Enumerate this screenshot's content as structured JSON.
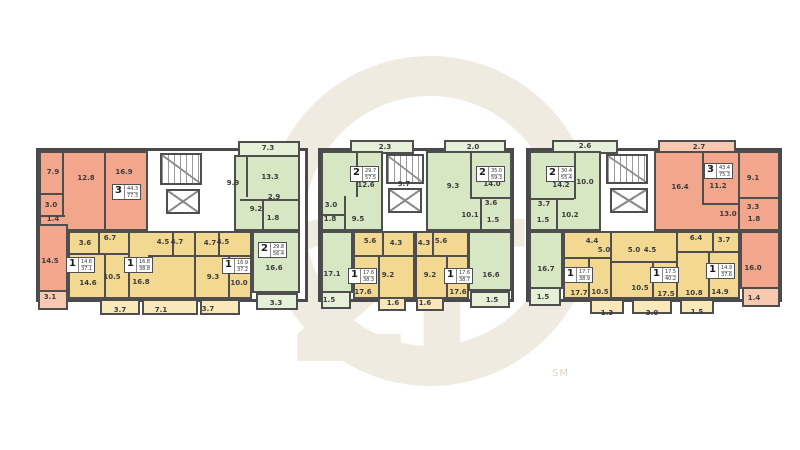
{
  "watermark": {
    "symbol": "2Г",
    "mark": "SM"
  },
  "b1": {
    "orange": {
      "badge": [
        "3",
        "44.3",
        "77.3"
      ],
      "rooms": [
        "7.9",
        "12.8",
        "16.9",
        "3.0",
        "1.4",
        "14.5",
        "3.1"
      ]
    },
    "green": {
      "badge": [
        "2",
        "29.8",
        "56.4"
      ],
      "rooms": [
        "7.3",
        "9.9",
        "13.3",
        "2.9",
        "9.2",
        "1.8",
        "16.6",
        "3.3"
      ]
    },
    "y1": {
      "badge": [
        "1",
        "14.6",
        "37.1"
      ],
      "rooms": [
        "3.6",
        "6.7",
        "14.6",
        "10.5",
        "3.7"
      ]
    },
    "y2": {
      "badge": [
        "1",
        "16.8",
        "38.8"
      ],
      "rooms": [
        "4.5",
        "4.7",
        "16.8",
        "7.1"
      ]
    },
    "y3": {
      "badge": [
        "1",
        "16.9",
        "37.2"
      ],
      "rooms": [
        "4.7",
        "4.5",
        "9.3",
        "10.0",
        "3.7"
      ]
    }
  },
  "b2": {
    "greenL": {
      "badge": [
        "2",
        "29.7",
        "57.5"
      ],
      "rooms": [
        "2.3",
        "12.6",
        "9.7",
        "3.0",
        "1.8",
        "9.5",
        "17.1",
        "1.5"
      ]
    },
    "greenR": {
      "badge": [
        "2",
        "35.0",
        "59.3"
      ],
      "rooms": [
        "2.0",
        "9.3",
        "14.0",
        "3.6",
        "1.5",
        "10.1",
        "16.6",
        "1.5"
      ]
    },
    "yL": {
      "badge": [
        "1",
        "17.6",
        "38.3"
      ],
      "rooms": [
        "5.6",
        "4.3",
        "9.2",
        "17.6",
        "1.6"
      ]
    },
    "yR": {
      "badge": [
        "1",
        "17.6",
        "38.7"
      ],
      "rooms": [
        "4.3",
        "5.6",
        "9.2",
        "17.6",
        "1.6"
      ]
    }
  },
  "b3": {
    "green": {
      "badge": [
        "2",
        "30.4",
        "55.4"
      ],
      "rooms": [
        "2.6",
        "14.2",
        "10.0",
        "3.7",
        "1.5",
        "10.2",
        "16.7",
        "1.5"
      ]
    },
    "orange": {
      "badge": [
        "3",
        "43.4",
        "75.3"
      ],
      "rooms": [
        "2.7",
        "16.4",
        "11.2",
        "9.1",
        "13.0",
        "3.3",
        "1.8",
        "16.0",
        "1.4"
      ]
    },
    "yL": {
      "badge": [
        "1",
        "17.7",
        "38.9"
      ],
      "rooms": [
        "4.4",
        "5.0",
        "17.7",
        "10.5",
        "1.3"
      ]
    },
    "yM": {
      "badge": [
        "1",
        "17.5",
        "40.2"
      ],
      "rooms": [
        "5.0",
        "4.5",
        "10.5",
        "17.5",
        "3.0"
      ]
    },
    "yR": {
      "badge": [
        "1",
        "14.9",
        "37.6"
      ],
      "rooms": [
        "6.4",
        "3.7",
        "10.8",
        "14.9",
        "1.5"
      ]
    }
  }
}
